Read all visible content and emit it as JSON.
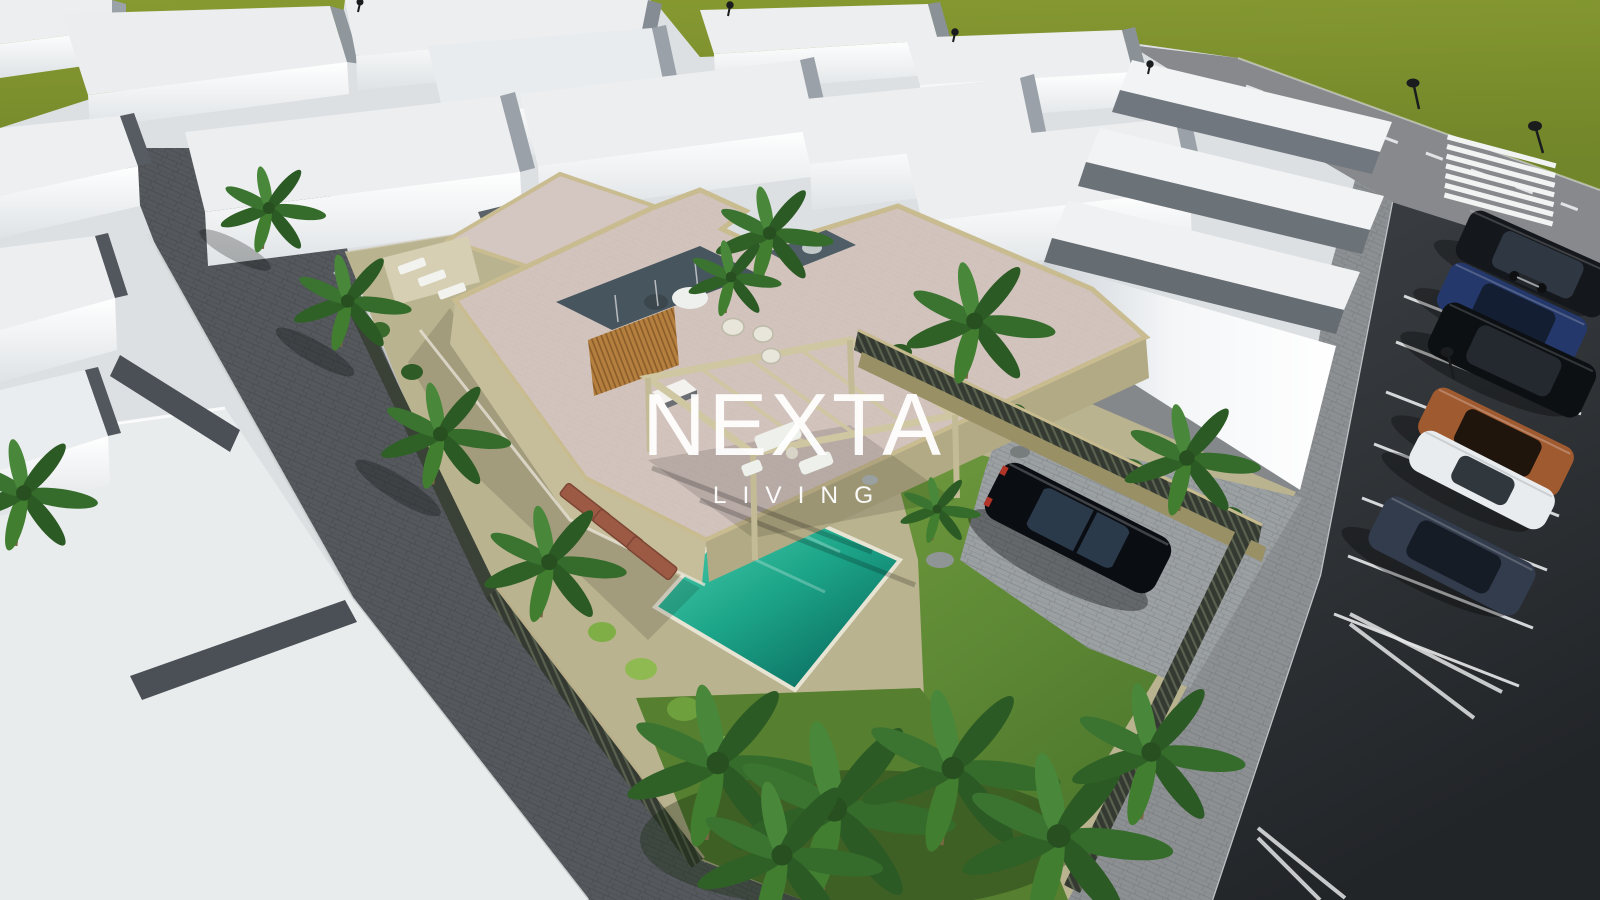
{
  "scene": {
    "type": "3D architectural rendering",
    "view": "aerial bird's-eye",
    "subject": "Modern two-storey villa with swimming pool, pergola and landscaped corner lot inside a residential development of white massing-model houses",
    "watermark": {
      "brand": "NEXTA",
      "tagline": "LIVING"
    },
    "palette": {
      "field_green": "#7e912d",
      "lawn_green": "#5d8734",
      "pool_turquoise": "#18a389",
      "lot_beige": "#bab38f",
      "roof_pink": "#d2c3bd",
      "roof_trim_beige": "#c9bc90",
      "wood_slats": "#b5803f",
      "building_white": "#fafbfd",
      "building_top_gray": "#eceef0",
      "shadow_gray": "#50565c",
      "asphalt_dark": "#2d3134",
      "paver_street_gray": "#55595d",
      "sidewalk_gray": "#8d9093",
      "watermark_white": "#ffffff"
    },
    "objects": {
      "parked_vehicles": [
        "black minivan",
        "motorcycle",
        "blue SUV",
        "black SUV",
        "copper SUV",
        "white sports car",
        "dark blue SUV"
      ],
      "driveway_vehicle": "black sedan",
      "street_features": [
        "zebra crosswalk",
        "dashed center line",
        "diagonal parking stall lines",
        "street lamps"
      ],
      "vegetation": [
        "palm trees",
        "hedge bushes",
        "lawn",
        "green field"
      ]
    }
  }
}
